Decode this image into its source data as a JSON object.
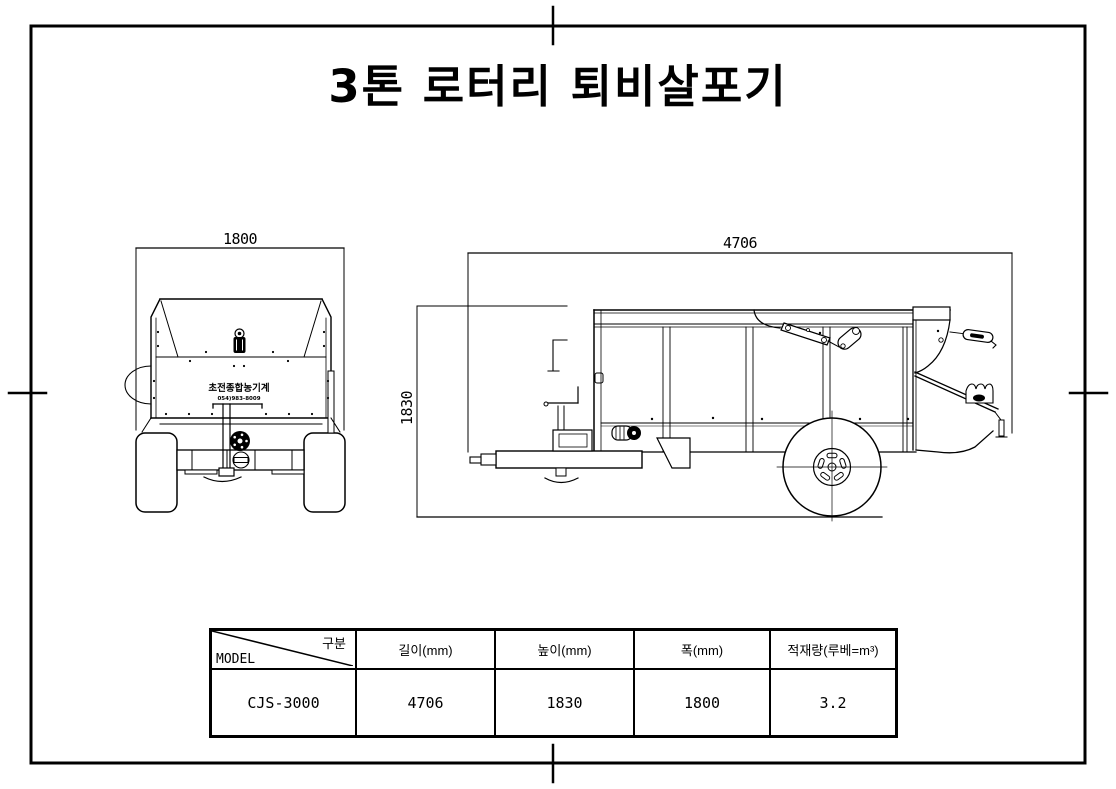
{
  "sheet": {
    "paper_color": "#ffffff",
    "ink_color": "#000000"
  },
  "title": "3톤 로터리 퇴비살포기",
  "front_view": {
    "width_dim": "1800",
    "brand_name": "초전종합농기계",
    "brand_phone": "054)983-8009"
  },
  "side_view": {
    "length_dim": "4706",
    "height_dim": "1830"
  },
  "spec_table": {
    "corner": {
      "top_label": "구분",
      "bottom_label": "MODEL"
    },
    "columns": [
      "길이(mm)",
      "높이(mm)",
      "폭(mm)",
      "적재량(루베=m³)"
    ],
    "row": {
      "model": "CJS-3000",
      "length": "4706",
      "height": "1830",
      "width": "1800",
      "capacity": "3.2"
    }
  }
}
